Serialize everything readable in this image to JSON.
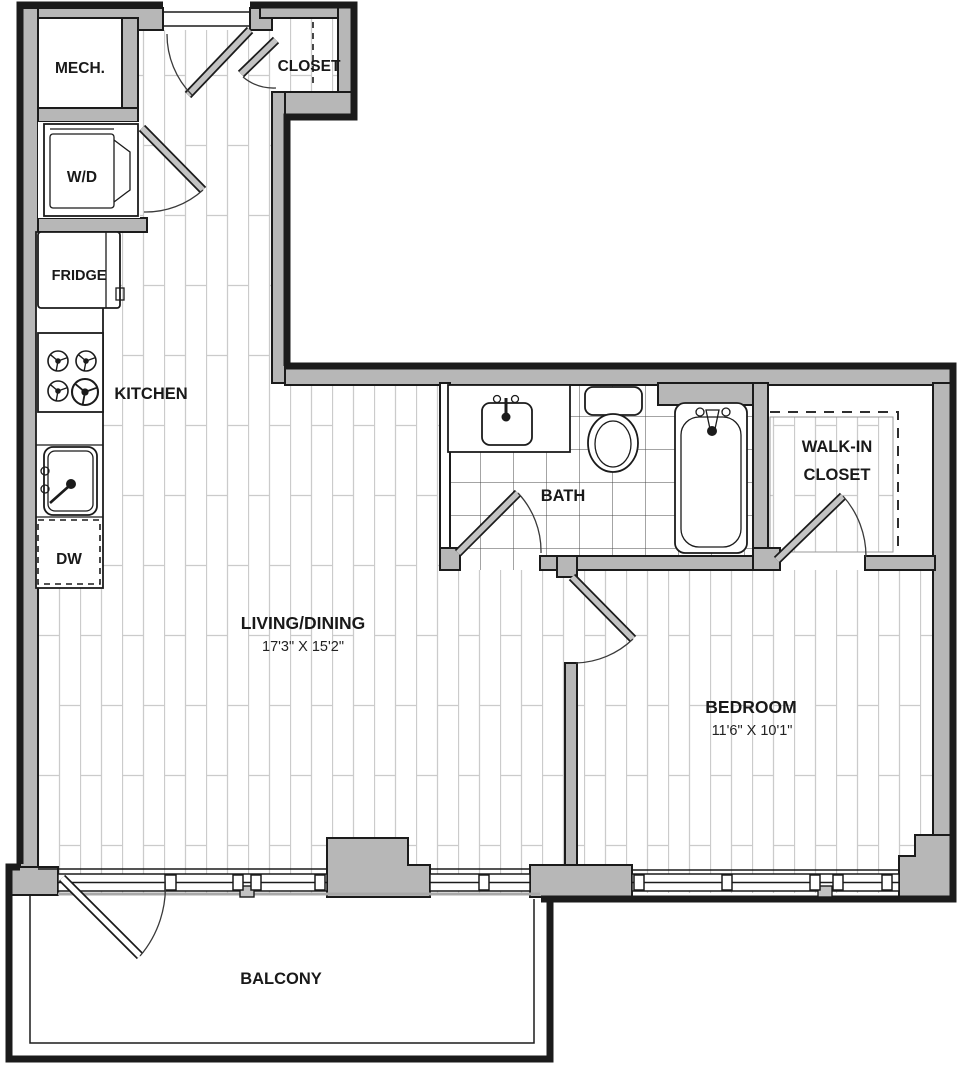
{
  "labels": {
    "mech": "MECH.",
    "wd": "W/D",
    "fridge": "FRIDGE",
    "kitchen": "KITCHEN",
    "dw": "DW",
    "closet": "CLOSET",
    "bath": "BATH",
    "walkin_line1": "WALK-IN",
    "walkin_line2": "CLOSET",
    "living": "LIVING/DINING",
    "living_dims": "17'3\" X 15'2\"",
    "bedroom": "BEDROOM",
    "bedroom_dims": "11'6\" X 10'1\"",
    "balcony": "BALCONY"
  },
  "colors": {
    "wall": "#b7b7b7",
    "line": "#1b1b1b",
    "leaf": "#c3c3c3",
    "plank": "#cbcbcb",
    "tile": "#4a4a4a"
  }
}
